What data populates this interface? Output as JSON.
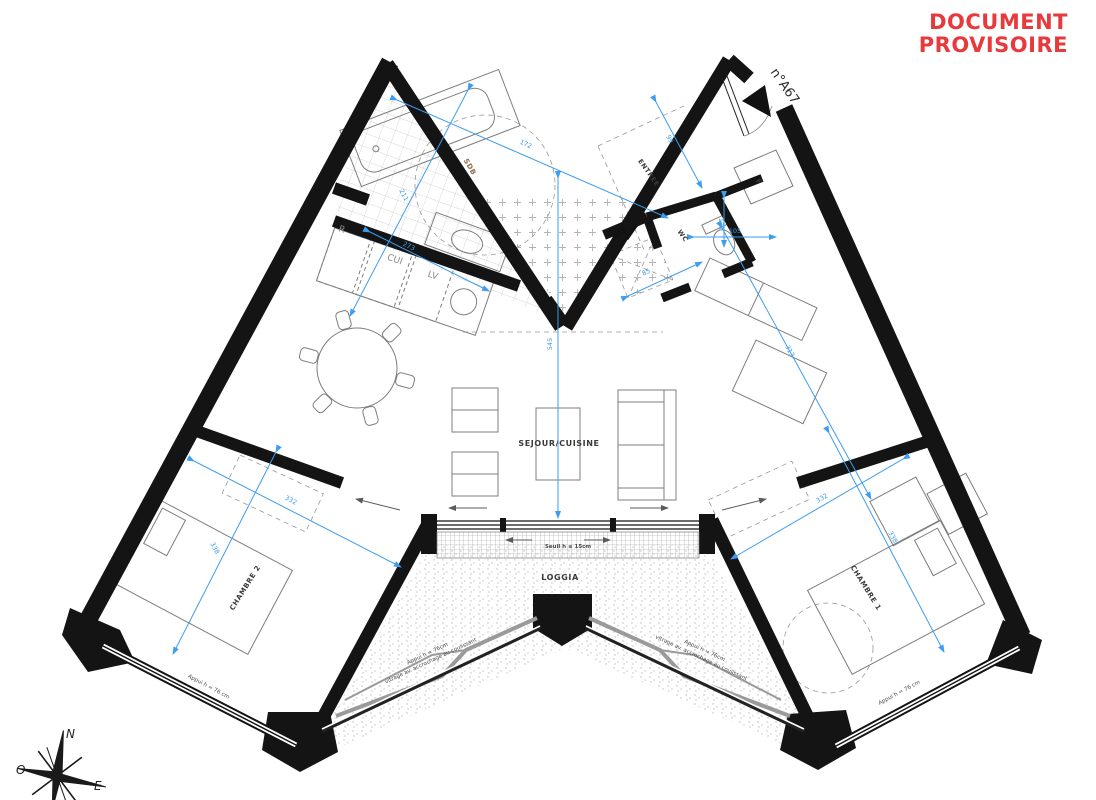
{
  "status_stamp": {
    "line1": "DOCUMENT",
    "line2": "PROVISOIRE",
    "color": "#e8393d"
  },
  "apartment": {
    "number": "n°A67"
  },
  "rooms": {
    "sdb": "SDB",
    "entree": "ENTREE",
    "wc": "WC",
    "closet": "F",
    "sejour": "SEJOUR/CUISINE",
    "chambre1": "CHAMBRE 1",
    "chambre2": "CHAMBRE 2",
    "loggia": "LOGGIA"
  },
  "kitchen": {
    "fridge": "R",
    "cooker": "CUI",
    "dishwasher": "LV"
  },
  "annotations": {
    "seuil": "Seuil h ≤ 15cm",
    "appui_chambre2": "Appui h = 76 cm",
    "appui_chambre1": "Appui h = 76 cm",
    "loggia_left_l1": "Appui h = 76cm",
    "loggia_left_l2": "vitrage av. accrochage au coulissant",
    "loggia_right_l1": "Appui h = 76cm",
    "loggia_right_l2": "vitrage av. accrochage au coulissant"
  },
  "dimensions": {
    "sdb_width": "172",
    "sdb_length": "211",
    "kitchen": "273",
    "sejour_depth": "545",
    "entree": "99",
    "wc_length": "131",
    "wc_width": "105",
    "degagement": "85",
    "sejour_right": "313",
    "chambre2_width": "332",
    "chambre2_depth": "338",
    "chambre1_width": "332",
    "chambre1_depth": "338"
  },
  "compass": {
    "north": "N",
    "west": "O",
    "east": "E"
  },
  "colors": {
    "dimension_blue": "#3d9df0",
    "wall_black": "#141414",
    "stamp_red": "#e8393d"
  }
}
